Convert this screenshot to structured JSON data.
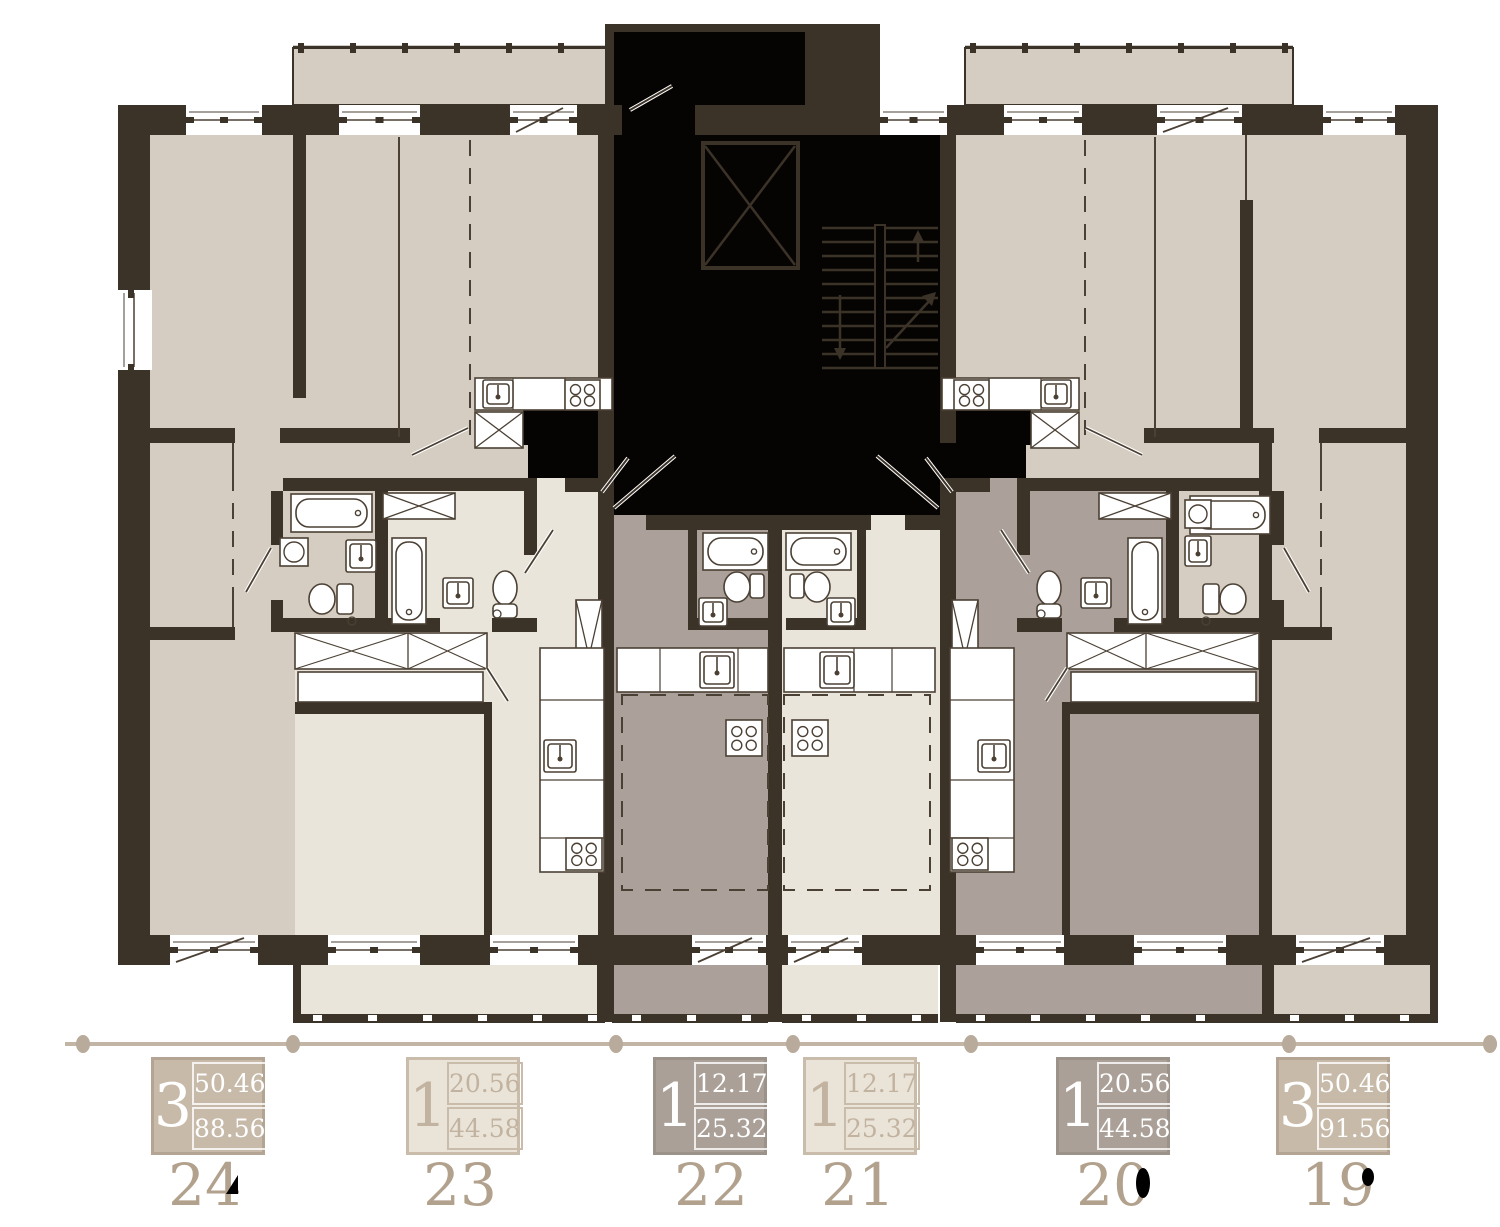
{
  "legend": {
    "apartments": [
      {
        "id": "24",
        "rooms": "3",
        "area_top": "50.46",
        "area_bottom": "88.56",
        "style": "tan"
      },
      {
        "id": "23",
        "rooms": "1",
        "area_top": "20.56",
        "area_bottom": "44.58",
        "style": "light"
      },
      {
        "id": "22",
        "rooms": "1",
        "area_top": "12.17",
        "area_bottom": "25.32",
        "style": "taupe"
      },
      {
        "id": "21",
        "rooms": "1",
        "area_top": "12.17",
        "area_bottom": "25.32",
        "style": "light"
      },
      {
        "id": "20",
        "rooms": "1",
        "area_top": "20.56",
        "area_bottom": "44.58",
        "style": "taupe"
      },
      {
        "id": "19",
        "rooms": "3",
        "area_top": "50.46",
        "area_bottom": "91.56",
        "style": "tan"
      }
    ]
  },
  "plan": {
    "symbols": [
      "elevator-shaft",
      "staircase",
      "bathtub",
      "toilet",
      "washbasin",
      "stove",
      "washer",
      "wardrobe",
      "window",
      "door-swing",
      "balcony-rail"
    ]
  },
  "colors": {
    "wall": "#3b3228",
    "core": "#060402",
    "beige": "#d5cdc1",
    "cream": "#eae5db",
    "taupe": "#aba19a",
    "fixture": "#4b4034",
    "legendLine": "#c3b5a5",
    "legendDot": "#b9ab9b",
    "numeral": "#b1a18d",
    "cardTanBg": "#c7baa9",
    "cardTanBorder": "#b3a493",
    "cardLightBg": "#eae4d8",
    "cardLightBorder": "#c9bcab",
    "cardLightText": "#c2b2a0",
    "cardTaupeBg": "#aaa098",
    "cardTaupeBorder": "#9b9289"
  }
}
